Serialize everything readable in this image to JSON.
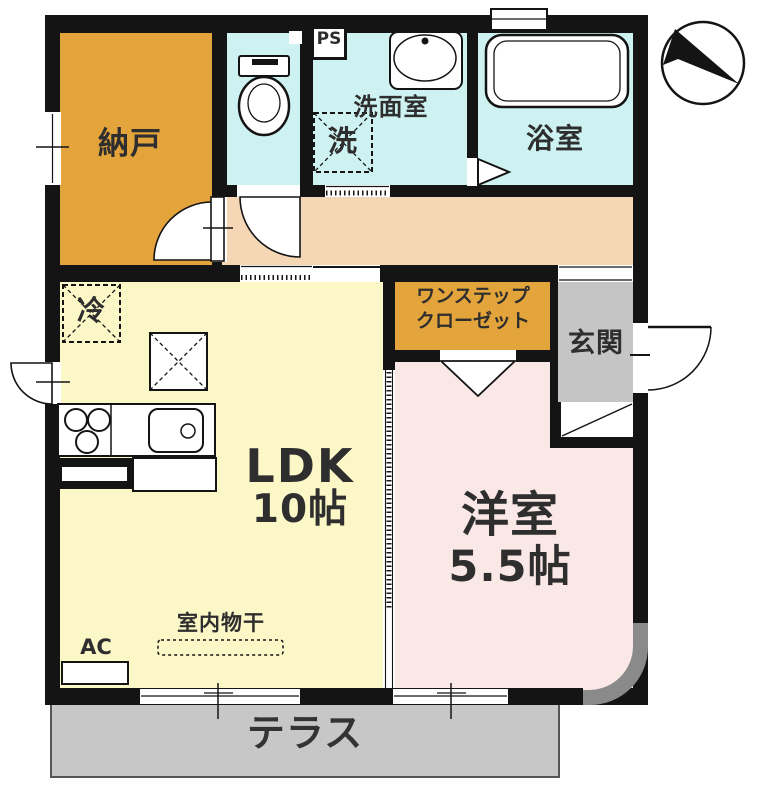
{
  "plan": {
    "nando": "納戸",
    "ps": "PS",
    "washroom": "洗面室",
    "laundry": "洗",
    "bath": "浴室",
    "fridge": "冷",
    "ldk": "LDK",
    "ldk_size": "10帖",
    "closet_line1": "ワンステップ",
    "closet_line2": "クローゼット",
    "genkan": "玄関",
    "western_room": "洋室",
    "western_room_size": "5.5帖",
    "indoor_drying": "室内物干",
    "ac": "AC",
    "terrace": "テラス"
  },
  "colors": {
    "wall": "#141414",
    "storage_orange": "#E3A43C",
    "wet_cyan": "#CEF2F1",
    "hall_peach": "#F5D7B5",
    "ldk_yellow": "#FBF7C6",
    "room_pink": "#FAE8E6",
    "genkan_gray": "#C5C5C5",
    "terrace_gray": "#C7C7C7",
    "corner_gray": "#8A8A8A"
  }
}
